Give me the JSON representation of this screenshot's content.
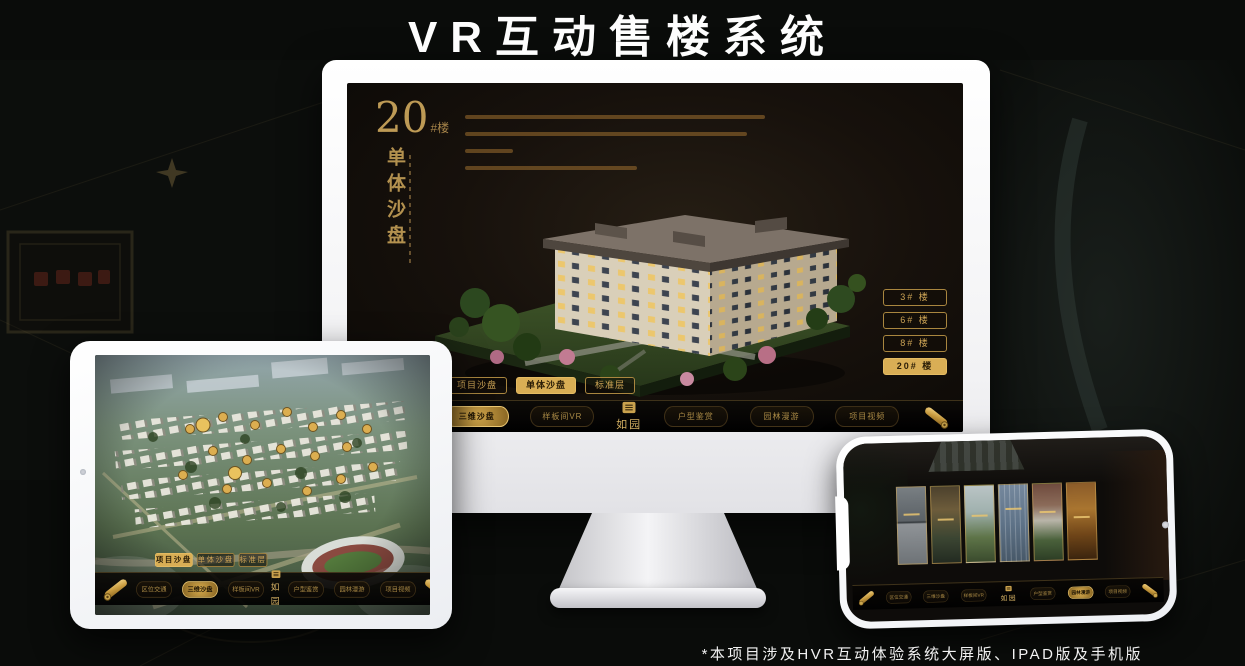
{
  "title": "VR互动售楼系统",
  "footnote": "*本项目涉及HVR互动体验系统大屏版、IPAD版及手机版",
  "colors": {
    "gold": "#cda455",
    "gold_active_bg": "#d9ae55",
    "screen_bg": "#16110c",
    "nav_bg": "#060504",
    "title_white": "#fdfdfd"
  },
  "desktop_screen": {
    "heading": {
      "number": "20",
      "suffix": "#楼",
      "vertical_title": "单体沙盘"
    },
    "floor_buttons": [
      {
        "label": "3# 楼",
        "active": false
      },
      {
        "label": "6# 楼",
        "active": false
      },
      {
        "label": "8# 楼",
        "active": false
      },
      {
        "label": "20# 楼",
        "active": true
      }
    ],
    "subtabs": [
      {
        "label": "项目沙盘",
        "active": false
      },
      {
        "label": "单体沙盘",
        "active": true
      },
      {
        "label": "标准层",
        "active": false
      }
    ],
    "nav": {
      "logo": "如园",
      "items": [
        {
          "label": "区位交通",
          "active": false
        },
        {
          "label": "三维沙盘",
          "active": true
        },
        {
          "label": "样板间VR",
          "active": false
        },
        {
          "label": "户型鉴赏",
          "active": false
        },
        {
          "label": "园林漫游",
          "active": false
        },
        {
          "label": "项目视频",
          "active": false
        }
      ]
    }
  },
  "tablet_screen": {
    "subtabs": [
      {
        "label": "项目沙盘",
        "active": true
      },
      {
        "label": "单体沙盘",
        "active": false
      },
      {
        "label": "标准层",
        "active": false
      }
    ],
    "nav": {
      "logo": "如园",
      "items": [
        {
          "label": "区位交通",
          "active": false
        },
        {
          "label": "三维沙盘",
          "active": true
        },
        {
          "label": "样板间VR",
          "active": false
        },
        {
          "label": "户型鉴赏",
          "active": false
        },
        {
          "label": "园林漫游",
          "active": false
        },
        {
          "label": "项目视频",
          "active": false
        }
      ]
    }
  },
  "phone_screen": {
    "nav": {
      "logo": "如园",
      "items": [
        {
          "label": "区位交通",
          "active": false
        },
        {
          "label": "三维沙盘",
          "active": false
        },
        {
          "label": "样板间VR",
          "active": false
        },
        {
          "label": "户型鉴赏",
          "active": false
        },
        {
          "label": "园林漫游",
          "active": true
        },
        {
          "label": "项目视频",
          "active": false
        }
      ]
    }
  }
}
